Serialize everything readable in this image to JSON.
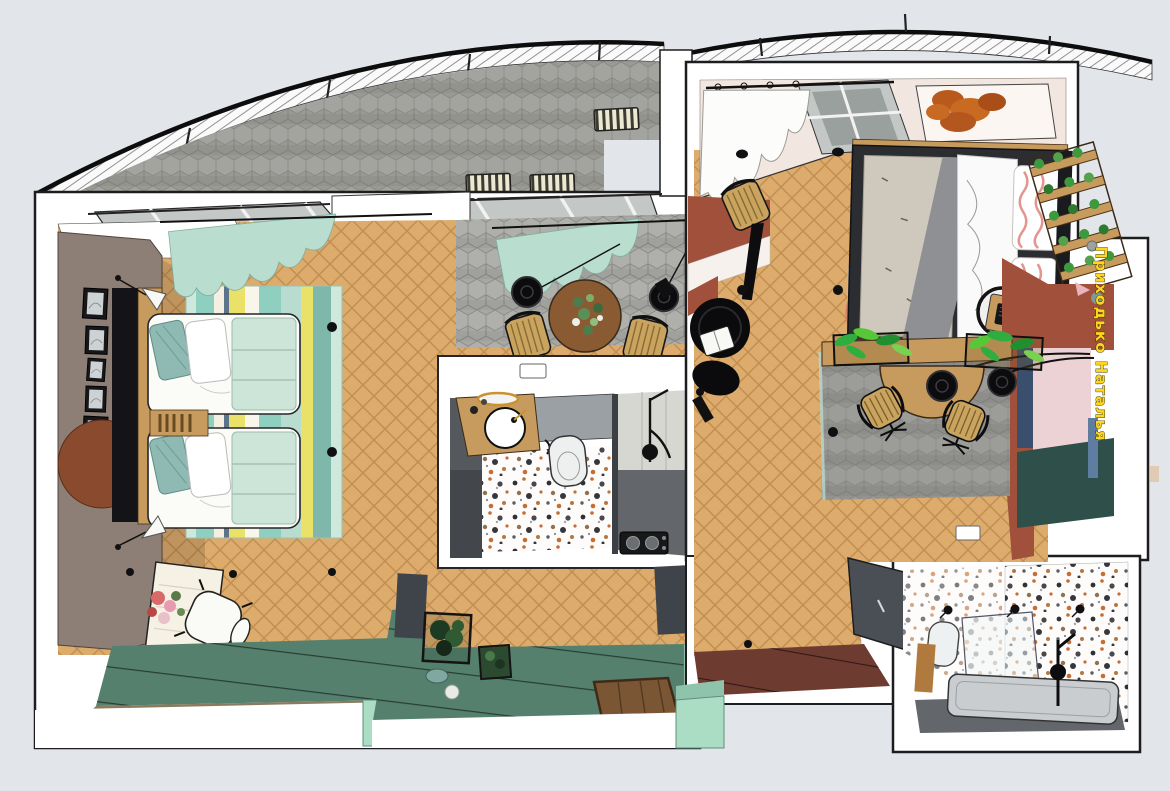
{
  "watermark": {
    "text": "Приходько Наталья"
  },
  "palette": {
    "bg": "#e2e6ea",
    "wall": "#ffffff",
    "line": "#1d1d1f",
    "wood": "#ddab6c",
    "woodLine": "#c08f52",
    "hexDining": "#a7a7a3",
    "hexBalcony": "#9a9a95",
    "hexLoggia": "#93938f",
    "hexLine": "#83827d",
    "taupe": "#8d7f75",
    "teal": "#55806d",
    "mint": "#abdcc4",
    "curtainMint": "#b9ddcf",
    "terracotta": "#a1503c",
    "maroon": "#6e3b31",
    "pinkWall": "#f2e6e1",
    "glass": "#c3c7c5",
    "grayCab": "#55595d",
    "showerWall": "#d7d7d2",
    "showerFloor": "#63676c",
    "terrazzoBg": "#fdfcfa",
    "tub": "#c9cdd0",
    "doorGray": "#4a4f55",
    "rugYellow": "#e9e168",
    "rugTeal": "#8fcfc0",
    "rugMintLt": "#cfe8dc",
    "rugBlue": "#5b748c",
    "quilt": "#cde4d8",
    "pillowTeal": "#8fb9b3",
    "counterWood": "#c79b5e",
    "gold": "#c8922e",
    "plantGreen": "#3c9a3c",
    "watermark": "#ffd61f",
    "bedBlanket": "#cfc8bc",
    "bedSheetGray": "#8f9093",
    "rugBedBg": "#eee6dc",
    "coral": "#d9826a",
    "navy": "#3a4e6e",
    "pinkMural": "#ecd2d4",
    "tealMural": "#2f4f4a",
    "blueBar": "#5e7da0"
  },
  "scene": {
    "type": "3d-floor-plan-top-view",
    "areas": [
      "terrace-balcony",
      "living-room",
      "dining-area",
      "bathroom",
      "entry-hall",
      "corridor",
      "bedroom",
      "loggia-workspace",
      "wardrobe",
      "bathroom-2"
    ]
  }
}
